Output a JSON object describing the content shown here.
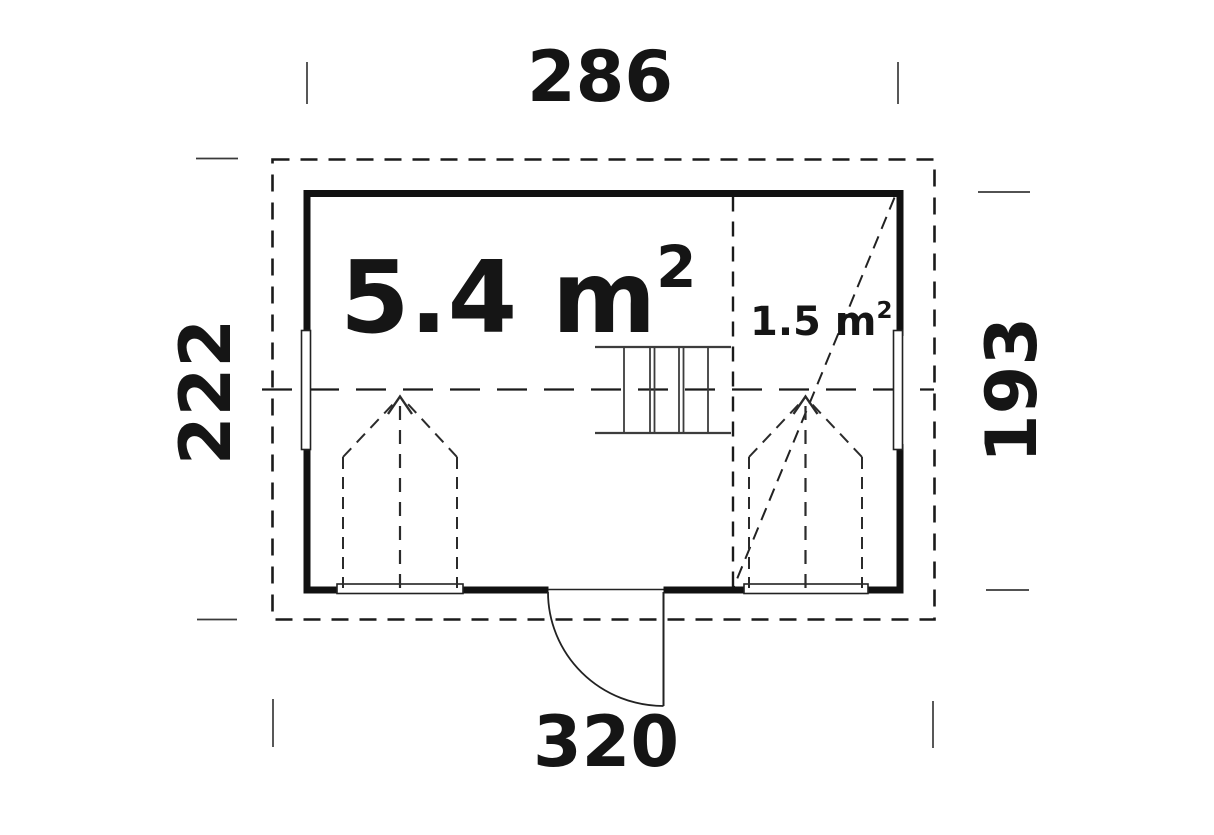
{
  "colors": {
    "line": "#1a1a1a",
    "thin_line": "#3a3a3a",
    "background": "#ffffff"
  },
  "dimensions": {
    "top": "286",
    "bottom": "320",
    "left": "222",
    "right": "193"
  },
  "rooms": {
    "main": {
      "area": "5.4 m",
      "area_superscript": "2"
    },
    "side": {
      "area": "1.5 m",
      "area_superscript": "2"
    }
  }
}
